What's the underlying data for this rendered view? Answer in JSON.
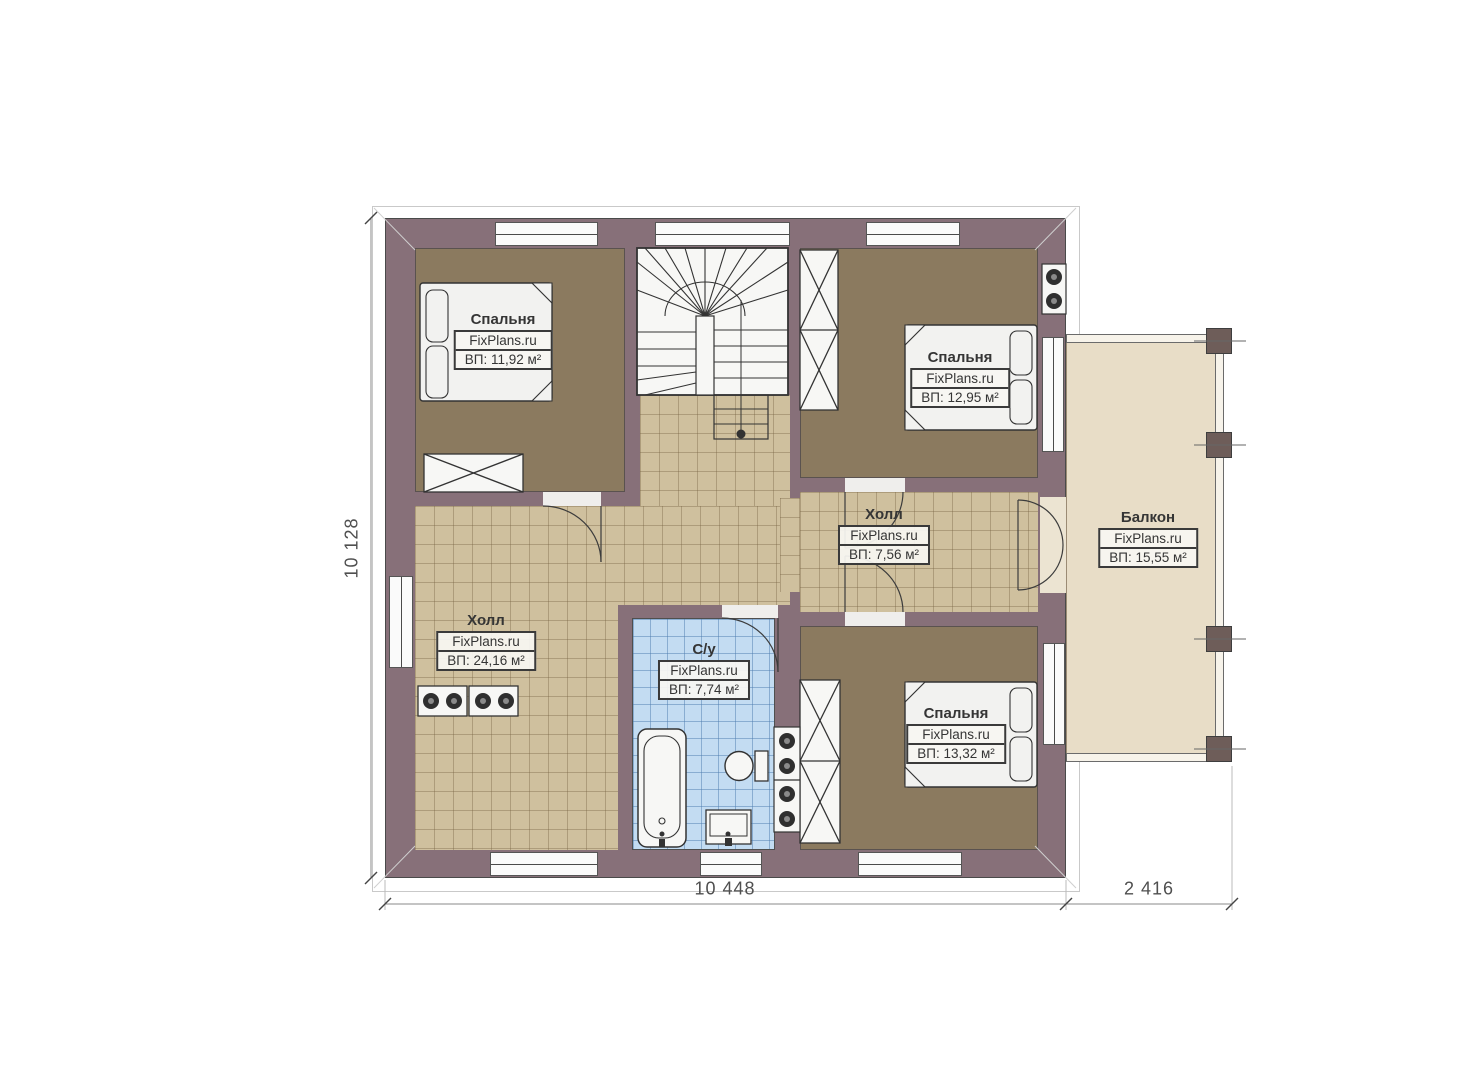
{
  "plan": {
    "rooms": [
      {
        "id": "bedroom-top-left",
        "name": "Спальня",
        "watermark": "FixPlans.ru",
        "area": "ВП: 11,92 м²"
      },
      {
        "id": "bedroom-top-right",
        "name": "Спальня",
        "watermark": "FixPlans.ru",
        "area": "ВП: 12,95 м²"
      },
      {
        "id": "hall-center",
        "name": "Холл",
        "watermark": "FixPlans.ru",
        "area": "ВП: 7,56 м²"
      },
      {
        "id": "balcony",
        "name": "Балкон",
        "watermark": "FixPlans.ru",
        "area": "ВП: 15,55 м²"
      },
      {
        "id": "hall-left",
        "name": "Холл",
        "watermark": "FixPlans.ru",
        "area": "ВП: 24,16 м²"
      },
      {
        "id": "bathroom",
        "name": "С/у",
        "watermark": "FixPlans.ru",
        "area": "ВП: 7,74 м²"
      },
      {
        "id": "bedroom-bottom-right",
        "name": "Спальня",
        "watermark": "FixPlans.ru",
        "area": "ВП: 13,32 м²"
      }
    ],
    "dimensions": {
      "left_height": "10 128",
      "bottom_main": "10 448",
      "bottom_balcony": "2 416"
    },
    "colors": {
      "wall": "#877079",
      "bedroom_floor": "#8b7a5f",
      "tile_floor": "#cfc09e",
      "bath_floor": "#c3dcf2",
      "balcony_floor": "#e8ddc7"
    }
  }
}
